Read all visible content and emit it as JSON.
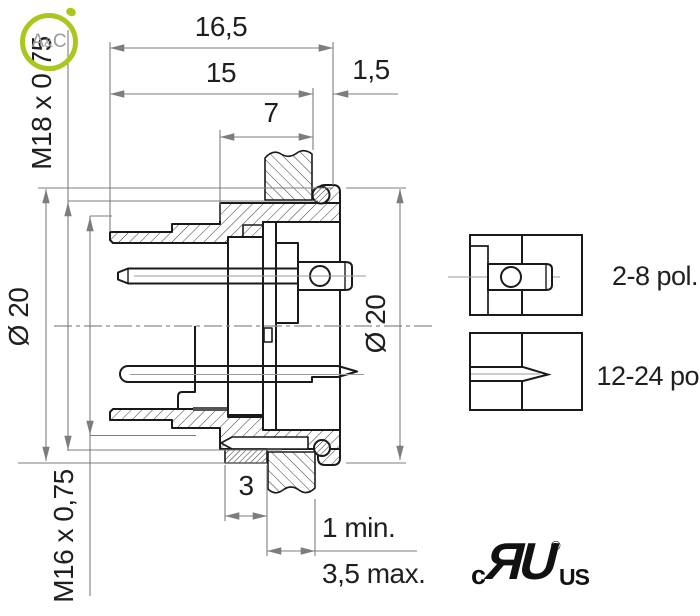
{
  "main_view": {
    "dim_16_5": "16,5",
    "dim_15": "15",
    "dim_1_5": "1,5",
    "dim_7": "7",
    "label_m18": "M18 x 0,75",
    "label_dia20_left": "Ø 20",
    "label_m16": "M16 x 0,75",
    "label_dia20_right": "Ø 20",
    "dim_3": "3",
    "dim_1_min": "1 min.",
    "dim_3_5_max": "3,5 max."
  },
  "detail_views": {
    "top_label": "2-8 pol.",
    "bottom_label": "12-24 pol."
  },
  "logo_ac": {
    "letter_a": "A",
    "ampersand": "&",
    "letter_c": "C"
  },
  "certification": {
    "c_prefix": "c",
    "ul_mark": "ЯU",
    "registered": "®",
    "us_suffix": "US"
  },
  "colors": {
    "outline": "#1a1a1a",
    "dimension_lines": "#7d7d7d",
    "accent_green": "#a9c81e",
    "logo_gray": "#9b9b9b"
  }
}
